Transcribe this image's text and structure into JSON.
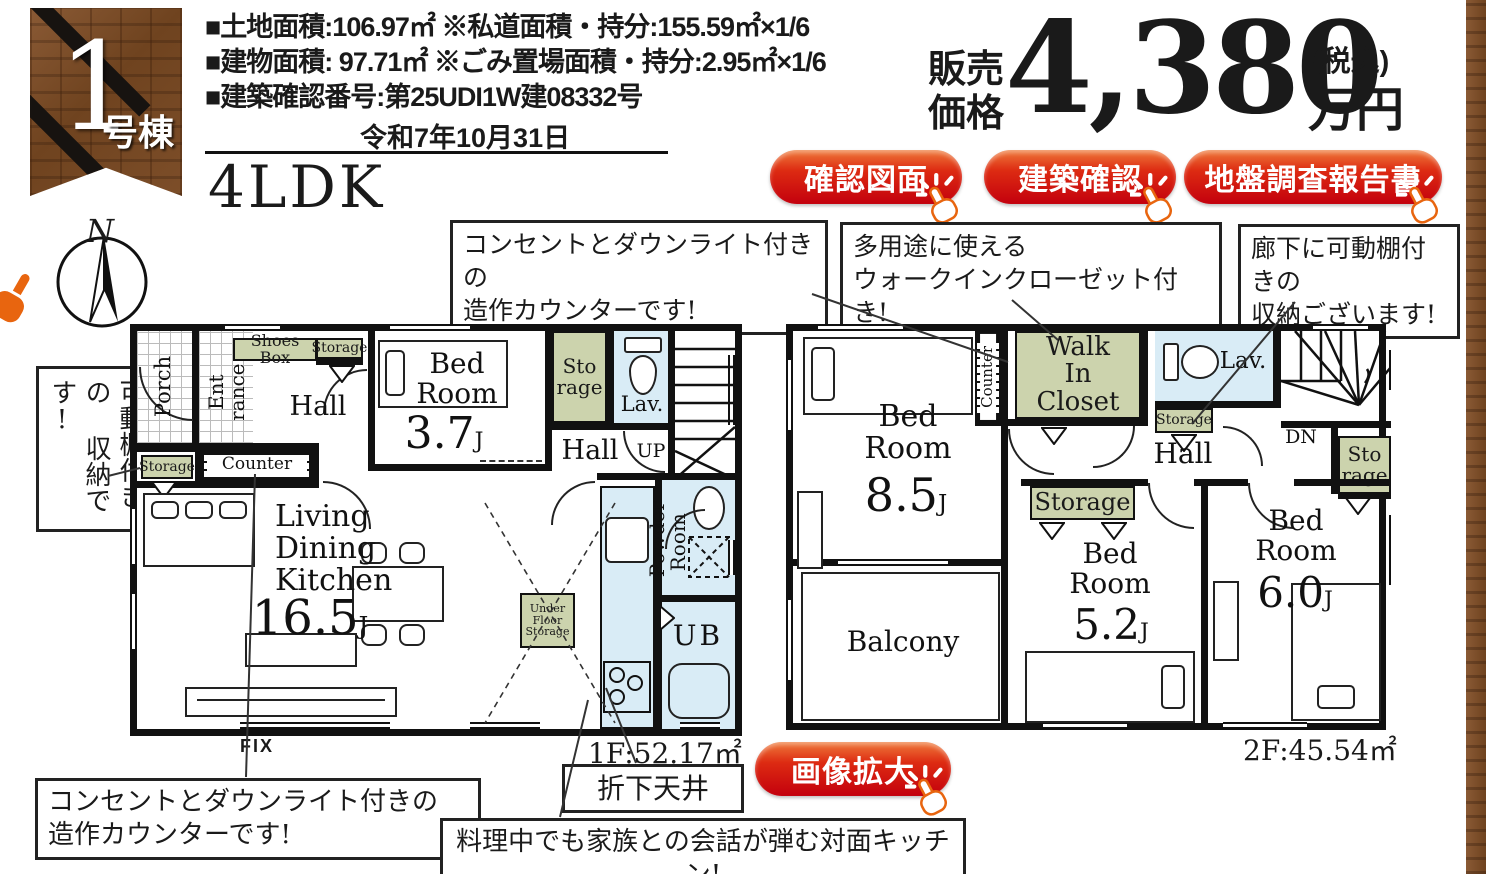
{
  "header": {
    "badge": {
      "number": "1",
      "label": "号棟"
    },
    "info_lines": [
      "■土地面積:106.97㎡ ※私道面積・持分:155.59㎡×1/6",
      "■建物面積: 97.71㎡ ※ごみ置場面積・持分:2.95㎡×1/6",
      "■建築確認番号:第25UDI1W建08332号",
      "令和7年10月31日"
    ],
    "layout_type": "4LDK"
  },
  "price": {
    "label": "販売\n価格",
    "amount": "4,380",
    "tax_note": "(税込)",
    "unit": "万円"
  },
  "action_buttons": [
    {
      "label": "確認図面"
    },
    {
      "label": "建築確認"
    },
    {
      "label": "地盤調査報告書"
    }
  ],
  "zoom_button": {
    "label": "画像拡大"
  },
  "callouts": {
    "counter_2f": "コンセントとダウンライト付きの\n造作カウンターです!",
    "wic": "多用途に使える\nウォークインクローゼット付き!",
    "hall_storage": "廊下に可動棚付きの\n収納ございます!",
    "shelf_storage": "可動棚付きの\n収納です!",
    "counter_1f": "コンセントとダウンライト付きの\n造作カウンターです!",
    "dropped_ceiling": "折下天井",
    "kitchen": "料理中でも家族との会話が弾む対面キッチン!"
  },
  "compass": {
    "north": "N"
  },
  "floor1": {
    "area": "1F:52.17㎡",
    "fix_window": "FIX",
    "rooms": {
      "porch": "Porch",
      "entrance": "Ent\nrance",
      "shoes_box": "Shoes Box",
      "storage_top": "Storage",
      "hall": "Hall",
      "bedroom_name": "Bed\nRoom",
      "bedroom_size": "3.7",
      "bedroom_unit": "J",
      "storage_mid": "Sto\nrage",
      "lav": "Lav.",
      "hall2": "Hall",
      "up": "UP",
      "storage_left": "Storage",
      "counter": "Counter",
      "ldk_name": "Living\nDining\nKitchen",
      "ldk_size": "16.5",
      "ldk_unit": "J",
      "under_floor": "Under\nFloor\nStorage",
      "powder": "Powder\nRoom",
      "ub": "UB"
    }
  },
  "floor2": {
    "area": "2F:45.54㎡",
    "rooms": {
      "bedroom85_name": "Bed\nRoom",
      "bedroom85_size": "8.5",
      "bedroom85_unit": "J",
      "counter": "Counter",
      "wic": "Walk\nIn\nCloset",
      "lav": "Lav.",
      "storage_small": "Storage",
      "hall": "Hall",
      "dn": "DN",
      "storage_right": "Sto\nrage",
      "storage_mid": "Storage",
      "bedroom52_name": "Bed\nRoom",
      "bedroom52_size": "5.2",
      "bedroom52_unit": "J",
      "bedroom60_name": "Bed\nRoom",
      "bedroom60_size": "6.0",
      "bedroom60_unit": "J",
      "balcony": "Balcony"
    }
  },
  "colors": {
    "accent_red": "#c3000d",
    "accent_orange": "#ef6a30",
    "storage_green": "#ccd3ad",
    "wet_blue": "#d9ecf6",
    "wall": "#111111",
    "wood": "#7b4f2e"
  }
}
